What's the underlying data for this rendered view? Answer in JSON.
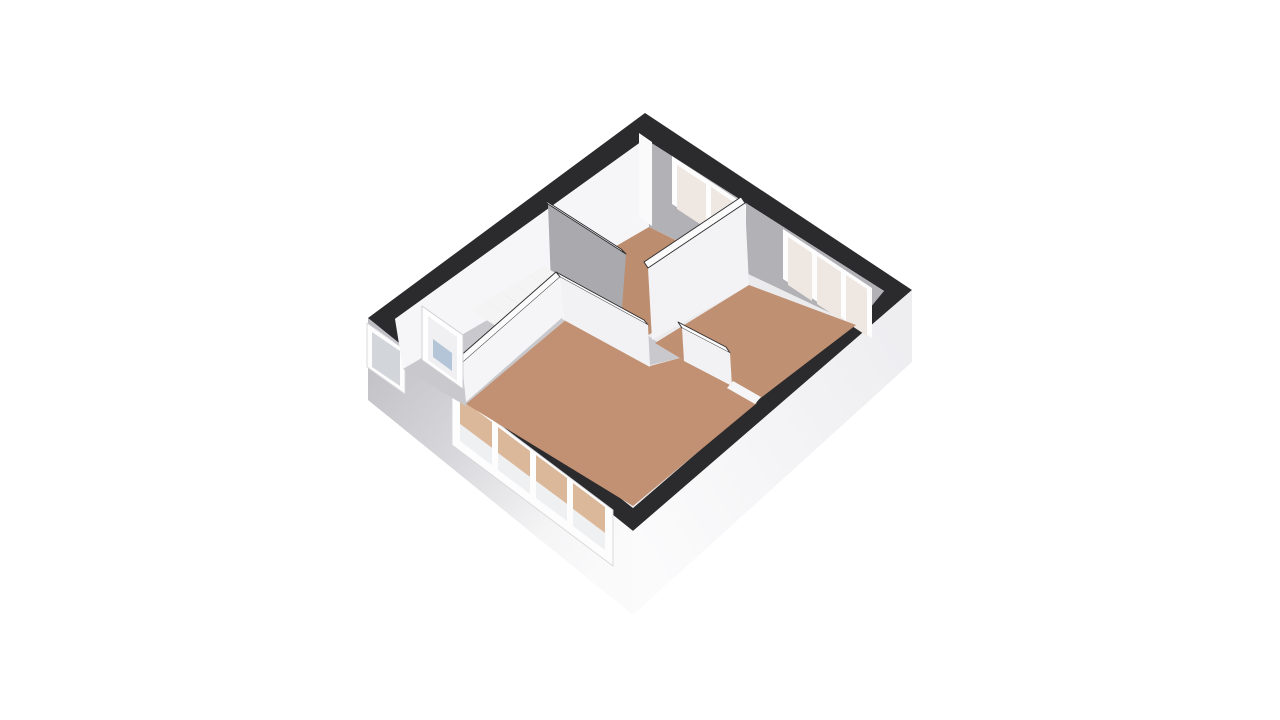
{
  "canvas": {
    "width": 1280,
    "height": 720,
    "background": "#ffffff"
  },
  "plan": {
    "description_label": "3d-floorplan-upper-floor",
    "rooms": [
      "bedroom-top",
      "bedroom-right",
      "living-room",
      "hallway-with-stairs"
    ],
    "colors": {
      "wall_top_band": "#2b2b2d",
      "interior_white_wall": "#f4f4f6",
      "interior_gray_wall": "#b1b1b6",
      "room_floor_brown": "#c09172",
      "hall_floor_gray": "#c9c9cd",
      "stairwell_gray": "#a6a6ab",
      "window_frame": "#fdfdfe",
      "window_glass_warm": "#efe7e1",
      "window_glass_brown": "#dcb89b",
      "door_glass_blue": "#b4c5d7"
    }
  },
  "scene": {
    "gradients": [
      {
        "id": "gradSW",
        "x1": 368,
        "y1": 318,
        "x2": 633,
        "y2": 531,
        "stops": [
          [
            "0",
            "#bcbcc1"
          ],
          [
            "0.45",
            "#d8d8dc"
          ],
          [
            "0.8",
            "#f5f5f6"
          ],
          [
            "1",
            "#fafafb"
          ]
        ]
      },
      {
        "id": "gradSE",
        "x1": 633,
        "y1": 531,
        "x2": 912,
        "y2": 362,
        "stops": [
          [
            "0",
            "#fbfbfc"
          ],
          [
            "1",
            "#eeeef1"
          ]
        ]
      }
    ],
    "paths": [
      {
        "name": "outer-wall-top-band",
        "d": "M645,113 L912,290 L633,531 L368,318 Z M645,139 L884,291 L633,508 L395,319 Z",
        "fill": "#2b2b2d",
        "rule": "evenodd"
      }
    ],
    "polygons": [
      {
        "name": "exterior-wall-sw-face",
        "points": "368,318 633,531 633,615 368,400",
        "fill": "url(#gradSW)"
      },
      {
        "name": "exterior-wall-se-face",
        "points": "633,531 912,290 912,362 633,615",
        "fill": "url(#gradSE)"
      },
      {
        "name": "hall-window-frame",
        "points": "367,323 405,350 405,394 367,367",
        "fill": "#fdfdfe",
        "stroke": "#d8d8dc"
      },
      {
        "name": "hall-window-pane",
        "points": "372,332 400,351 400,386 372,367",
        "fill": "#d2d5d9"
      },
      {
        "name": "living-window-frame",
        "points": "452,389 613,510 613,566 452,445",
        "fill": "#fdfdfe",
        "stroke": "#d8d8dc"
      },
      {
        "name": "living-window-pane-1-upper",
        "points": "460,398 492,422 492,448 460,424",
        "fill": "#dcb89b"
      },
      {
        "name": "living-window-pane-1-lower",
        "points": "460,424 492,448 492,465 460,441",
        "fill": "#eef0f2"
      },
      {
        "name": "living-window-pane-2-upper",
        "points": "498,427 530,451 530,477 498,453",
        "fill": "#dcb89b"
      },
      {
        "name": "living-window-pane-2-lower",
        "points": "498,453 530,477 530,494 498,470",
        "fill": "#eef0f2"
      },
      {
        "name": "living-window-pane-3-upper",
        "points": "536,455 567,478 567,504 536,481",
        "fill": "#dcb89b"
      },
      {
        "name": "living-window-pane-3-lower",
        "points": "536,481 567,504 567,521 536,498",
        "fill": "#eef0f2"
      },
      {
        "name": "living-window-pane-4-upper",
        "points": "573,483 605,507 605,533 573,509",
        "fill": "#dcb89b"
      },
      {
        "name": "living-window-pane-4-lower",
        "points": "573,509 605,533 605,550 573,526",
        "fill": "#eef0f2"
      },
      {
        "name": "interior-base",
        "points": "645,139 884,291 633,508 395,319",
        "fill": "#ebebed"
      },
      {
        "name": "nw-wall-interior-face",
        "points": "645,139 395,319 403,369 649,227",
        "fill": "#f6f6f8"
      },
      {
        "name": "ne-wall-interior-face",
        "points": "645,139 884,291 856,325 649,227",
        "fill": "#b1b1b6"
      },
      {
        "name": "corner-pilaster",
        "points": "639,133 652,142 652,226 639,217",
        "fill": "#fafafb"
      },
      {
        "name": "bedroom-top-window-frame",
        "points": "672,156 746,205 746,253 672,204",
        "fill": "#fdfdfe"
      },
      {
        "name": "bedroom-top-window-pane-1",
        "points": "677,165 706,184 706,228 677,209",
        "fill": "#efe7e1"
      },
      {
        "name": "bedroom-top-window-pane-2",
        "points": "711,187 741,207 741,250 711,230",
        "fill": "#efe7e1"
      },
      {
        "name": "bedroom-right-window-frame",
        "points": "783,229 872,288 872,338 783,279",
        "fill": "#fdfdfe"
      },
      {
        "name": "bedroom-right-window-pane-1",
        "points": "788,237 812,253 812,301 788,285",
        "fill": "#efe7e1"
      },
      {
        "name": "bedroom-right-window-pane-2",
        "points": "817,256 841,272 841,320 817,304",
        "fill": "#efe7e1"
      },
      {
        "name": "bedroom-right-window-pane-3",
        "points": "846,275 867,289 867,336 846,322",
        "fill": "#efe7e1"
      },
      {
        "name": "bedroom-top-floor",
        "points": "649,227 742,272 644,338 551,284",
        "fill": "#bd8d6f"
      },
      {
        "name": "hall-floor-strip",
        "points": "551,284 640,330 680,358 650,365 568,318 496,315",
        "fill": "#c9c9cd"
      },
      {
        "name": "hall-floor-arm",
        "points": "496,315 570,316 466,406 403,369",
        "fill": "#c9c9cd"
      },
      {
        "name": "stairwell-void",
        "points": "551,284 621,322 598,340 532,300",
        "fill": "#a6a6ab"
      },
      {
        "name": "wall-hall-bedroom-top-face",
        "points": "548,204 626,254 621,322 551,284",
        "fill": "#a9a9ae"
      },
      {
        "name": "wall-hall-bedroom-top-cap",
        "points": "543,199 621,249 626,254 548,204",
        "fill": "#fbfbfc",
        "stroke": "#2b2b2d"
      },
      {
        "name": "staircase-body",
        "points": "470,310 544,266 570,282 496,326",
        "fill": "#f4f4f5"
      },
      {
        "name": "stair-riser-1",
        "points": "485,301 511,317 514,319 488,303",
        "fill": "#d7d7da"
      },
      {
        "name": "stair-riser-2",
        "points": "500,292 526,308 529,310 503,294",
        "fill": "#d7d7da"
      },
      {
        "name": "stair-riser-3",
        "points": "514,284 540,300 543,302 517,286",
        "fill": "#d7d7da"
      },
      {
        "name": "stair-riser-4",
        "points": "529,275 555,291 558,293 532,277",
        "fill": "#d7d7da"
      },
      {
        "name": "staircase-stringer",
        "points": "496,326 570,282 574,290 500,334",
        "fill": "#e2e2e5"
      },
      {
        "name": "wall-between-bedrooms-face",
        "points": "745,203 648,268 652,340 749,285",
        "fill": "#f3f3f5"
      },
      {
        "name": "wall-between-bedrooms-cap",
        "points": "741,197 644,262 648,268 745,203",
        "fill": "#fbfbfc",
        "stroke": "#2b2b2d"
      },
      {
        "name": "bedroom-right-floor",
        "points": "749,285 856,325 758,400 740,390 680,358 655,343",
        "fill": "#c09072"
      },
      {
        "name": "living-room-floor",
        "points": "568,318 650,366 680,358 732,386 757,403 633,506 466,404",
        "fill": "#c29173"
      },
      {
        "name": "doorway-threshold",
        "points": "733,381 761,397 755,404 727,388",
        "fill": "#f6f6f8"
      },
      {
        "name": "wall-bedroom-right-living-cap",
        "points": "678,322 726,347 730,353 682,328",
        "fill": "#fbfbfc",
        "stroke": "#2b2b2d"
      },
      {
        "name": "wall-bedroom-right-living-face",
        "points": "682,328 730,353 732,386 684,361",
        "fill": "#f2f2f4"
      },
      {
        "name": "wall-hall-living-cap",
        "points": "556,272 644,320 648,325 560,277",
        "fill": "#fbfbfc",
        "stroke": "#2b2b2d"
      },
      {
        "name": "wall-hall-living-face",
        "points": "560,277 648,325 650,367 562,319",
        "fill": "#f2f2f4"
      },
      {
        "name": "wall-living-left-cap",
        "points": "556,272 458,358 462,363 560,277",
        "fill": "#fbfbfc",
        "stroke": "#2b2b2d"
      },
      {
        "name": "wall-living-left-face",
        "points": "560,277 462,363 466,402 564,316",
        "fill": "#f5f5f7"
      },
      {
        "name": "front-door-frame",
        "points": "422,306 463,335 463,389 422,360",
        "fill": "#fefefe",
        "stroke": "#cfcfd4"
      },
      {
        "name": "front-door-leaf",
        "points": "428,316 457,337 457,381 428,360",
        "fill": "#f0f0f2"
      },
      {
        "name": "front-door-glass",
        "points": "433,339 452,353 452,371 433,357",
        "fill": "#b4c5d7"
      }
    ]
  }
}
